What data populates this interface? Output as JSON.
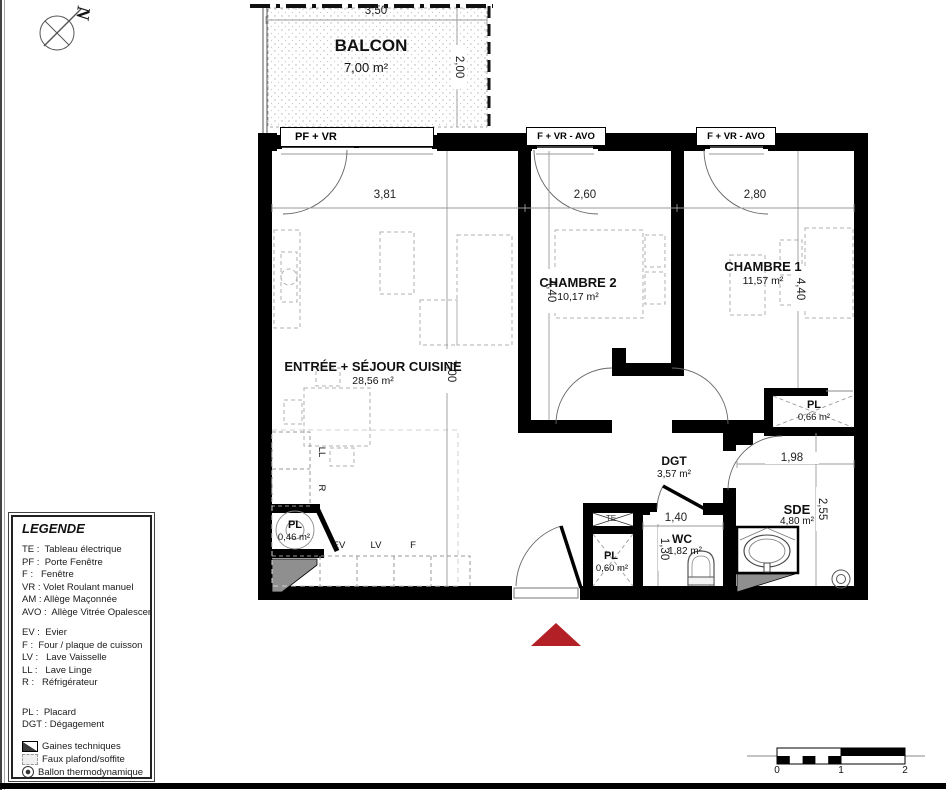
{
  "compass": {
    "north": "N"
  },
  "balcony": {
    "name": "BALCON",
    "area": "7,00 m²"
  },
  "window_labels": {
    "balcony_door": "PF + VR",
    "bedroom2_window": "F + VR - AVO",
    "bedroom1_window": "F + VR - AVO"
  },
  "rooms": {
    "living": {
      "name": "ENTRÉE + SÉJOUR CUISINE",
      "area": "28,56 m²"
    },
    "bedroom2": {
      "name": "CHAMBRE 2",
      "area": "10,17 m²"
    },
    "bedroom1": {
      "name": "CHAMBRE 1",
      "area": "11,57 m²"
    },
    "hallway": {
      "name": "DGT",
      "area": "3,57 m²"
    },
    "shower": {
      "name": "SDE",
      "area": "4,80 m²"
    },
    "wc": {
      "name": "WC",
      "area": "1,82 m²"
    },
    "closet_bedroom1": {
      "name": "PL",
      "area": "0,66 m²"
    },
    "closet_hall": {
      "name": "PL",
      "area": "0,60 m²"
    },
    "closet_living": {
      "name": "PL",
      "area": "0,46 m²"
    }
  },
  "fixtures": {
    "electrical_panel": "TE",
    "sink": "EV",
    "dishwasher": "LV",
    "oven": "F",
    "washer": "LL",
    "fridge": "R"
  },
  "dimensions": {
    "balcony_width": "3,50",
    "balcony_depth": "2,00",
    "living_width": "3,81",
    "bedroom2_width": "2,60",
    "bedroom1_width": "2,80",
    "bedroom2_depth": "4,40",
    "bedroom1_depth": "4,40",
    "living_depth": "7,00",
    "closet_line": "1,98",
    "shower_depth": "2,55",
    "wc_width": "1,40",
    "wc_depth": "1,30"
  },
  "legend": {
    "title": "LEGENDE",
    "entries": [
      "TE :  Tableau électrique",
      "PF :  Porte Fenêtre",
      "F :   Fenêtre",
      "VR : Volet Roulant manuel",
      "AM : Allège Maçonnée",
      "AVO :  Allège Vitrée Opalescent",
      "EV :  Evier",
      "F :  Four / plaque de cuisson",
      "LV :   Lave Vaisselle",
      "LL :   Lave Linge",
      "R :   Réfrigérateur",
      "PL :  Placard",
      "DGT : Dégagement"
    ],
    "symbols": [
      {
        "icon": "gaines-icon",
        "text": "Gaines techniques"
      },
      {
        "icon": "faux-plafond-icon",
        "text": "Faux plafond/soffite"
      },
      {
        "icon": "ballon-icon",
        "text": "Ballon thermodynamique"
      }
    ]
  },
  "scale_bar": {
    "labels": [
      "0",
      "1",
      "2"
    ]
  },
  "colors": {
    "entrance_arrow": "#b32025",
    "wall": "#000000"
  }
}
